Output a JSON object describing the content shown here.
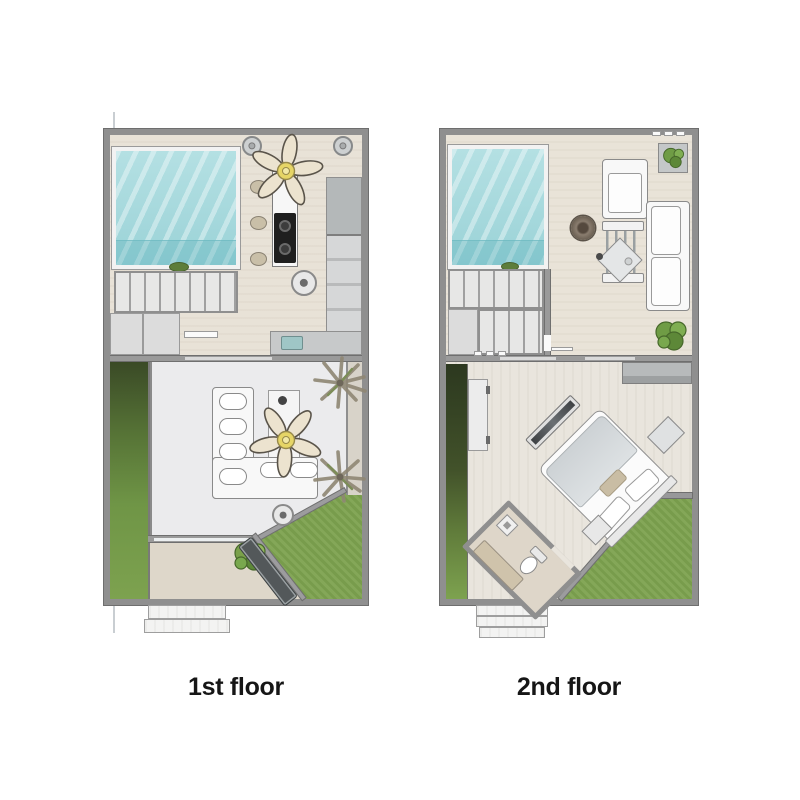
{
  "labels": {
    "first_floor": "1st floor",
    "second_floor": "2nd floor"
  },
  "colors": {
    "background": "#ffffff",
    "wall": "#8f8f8f",
    "pool_water": "#a9dade",
    "grass": "#7da24f",
    "grass_dark": "#3a4a26",
    "kitchen_floor": "#e8e2d7",
    "living_floor": "#ebebed",
    "lounge_floor": "#e9e3d8",
    "bedroom_floor": "#e9e5dd",
    "patio_floor": "#ded7ca",
    "fan_blade": "#ece3cf",
    "fan_hub": "#e6d566",
    "furniture_white": "#f8f8f8",
    "counter_gray": "#c7c9ca",
    "sink_teal": "#9fc6c6",
    "console_dark": "#3f4245",
    "doormat": "#53585a",
    "label_text": "#161616"
  },
  "plans": [
    {
      "id": "first-floor",
      "label": "1st floor",
      "features": [
        "swimming-pool",
        "kitchen",
        "ceiling-fan",
        "kitchen-island-stove",
        "bar-stools",
        "ceiling-lights",
        "refrigerator-counters",
        "sink",
        "staircase",
        "storage-closet",
        "living-room",
        "l-shaped-sofa",
        "tv-cabinet",
        "floor-speakers",
        "palm-plants",
        "garden-grass",
        "patio",
        "shrub",
        "doormat",
        "entry-steps"
      ]
    },
    {
      "id": "second-floor",
      "label": "2nd floor",
      "features": [
        "swimming-pool-void",
        "staircase",
        "lounge",
        "armchair",
        "sofa",
        "side-chair",
        "coffee-table",
        "round-rug",
        "potted-plant",
        "garden-bush",
        "desk-shelf",
        "bedroom",
        "double-bed",
        "pillows",
        "nightstands",
        "tv-console",
        "wardrobe",
        "planter",
        "garden-grass",
        "bathroom",
        "toilet",
        "vanity",
        "shower-drain",
        "entry-steps"
      ]
    }
  ]
}
